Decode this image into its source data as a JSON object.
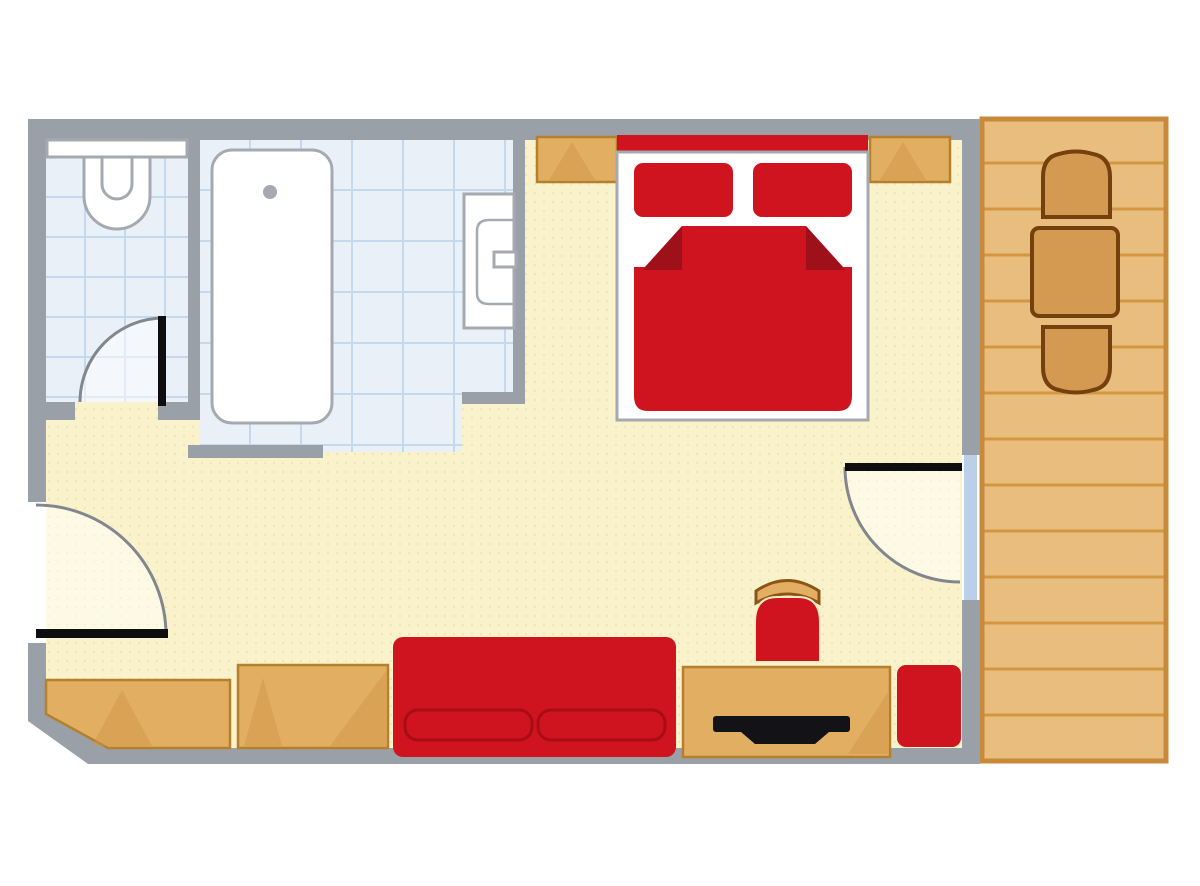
{
  "image": {
    "type": "floor-plan-illustration",
    "description_semantic": "hotel-room-floor-plan",
    "background": "#ffffff",
    "contains_text": false
  },
  "palette": {
    "wall": "#9aa0a7",
    "floor": "#f9f2cb",
    "floorDot": "#e8d9a0",
    "tileBase": "#e9f0f8",
    "tileLine": "#c5d9ee",
    "fixtureFill": "#ffffff",
    "fixtureLine": "#a5aab1",
    "red": "#cf1420",
    "redDark": "#9e111b",
    "redLine": "#a80d16",
    "wood": "#e2ae61",
    "woodBorder": "#b5802d",
    "woodShade": "#cf9544",
    "woodDarkLine": "#8d5418",
    "deck": "#e9bd7e",
    "deckLine": "#d2973f",
    "deckBorder": "#c8893a",
    "deckFurniture": "#d49a52",
    "deckFurnitureLine": "#74400d",
    "leaf": "#0e0e10",
    "arc": "#82878e",
    "glass": "#b9d0e8",
    "tv": "#131317",
    "seatOutline": "#f5ecc0"
  },
  "rooms": [
    {
      "id": "wc",
      "floor": "blue-tile",
      "fixtures": [
        "toilet",
        "shelf"
      ],
      "door": "swing"
    },
    {
      "id": "bathroom",
      "floor": "blue-tile",
      "fixtures": [
        "bathtub",
        "sink"
      ],
      "door": "open-passage"
    },
    {
      "id": "bedroom",
      "floor": "cream",
      "door": "swing-left-wall"
    },
    {
      "id": "terrace",
      "floor": "wood-plank",
      "door": "swing-glass"
    }
  ],
  "furniture": [
    "double-bed",
    "pillow-left",
    "pillow-right",
    "blanket",
    "headboard",
    "nightstand-left",
    "nightstand-right",
    "sofa",
    "desk",
    "tv",
    "desk-chair",
    "armchair",
    "wardrobe-left",
    "wardrobe-center",
    "terrace-chair-top",
    "terrace-table",
    "terrace-chair-bottom"
  ]
}
